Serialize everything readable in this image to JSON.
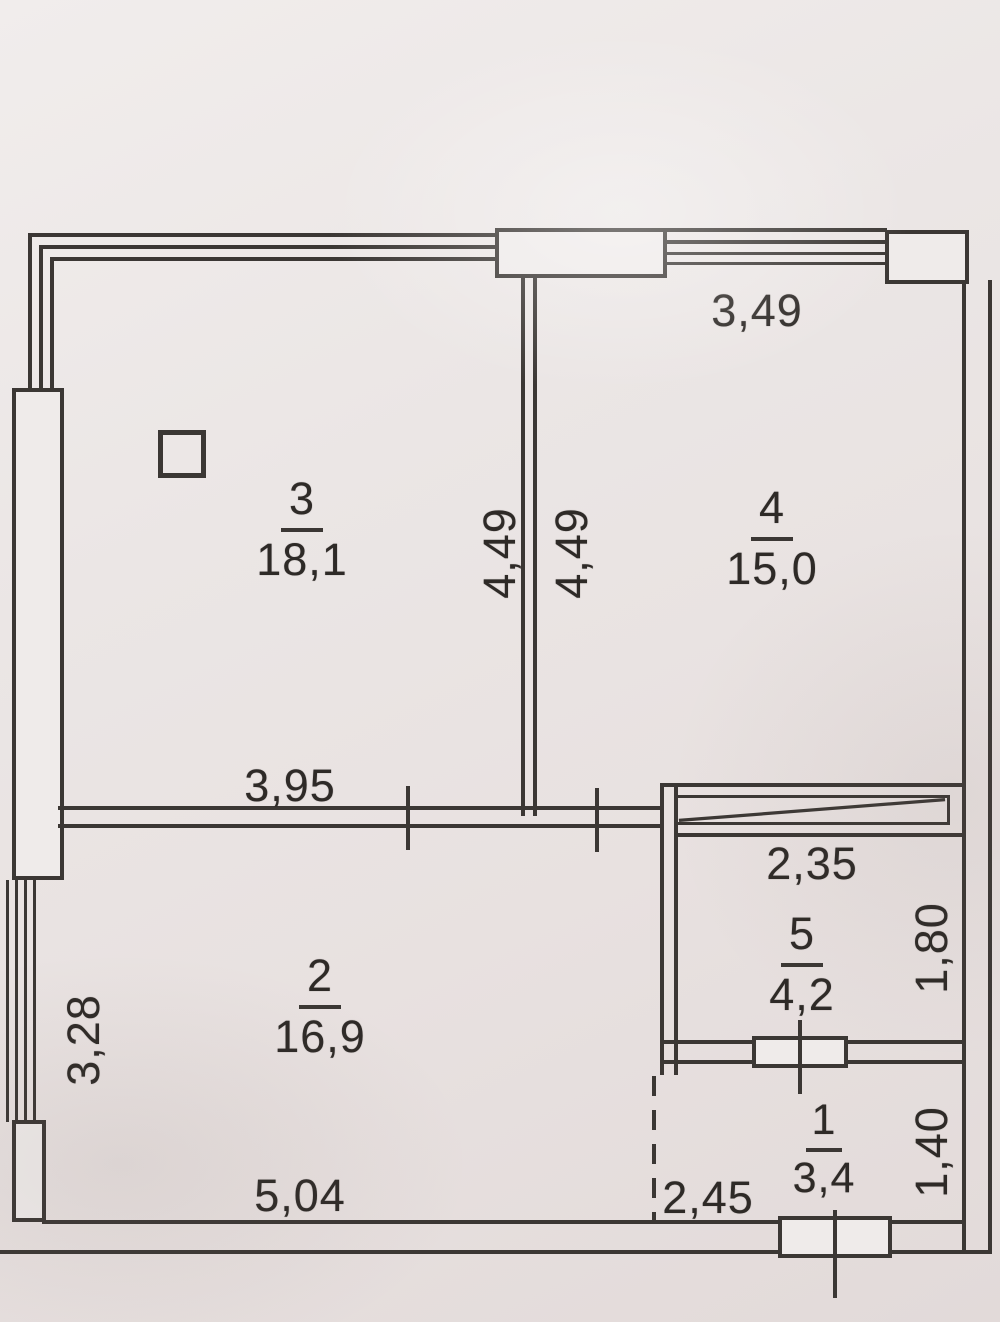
{
  "title": "Apartment floor plan scan",
  "colors": {
    "paper": "#eae5e4",
    "ink": "#3b3734"
  },
  "rooms": [
    {
      "number": "3",
      "area": "18,1"
    },
    {
      "number": "4",
      "area": "15,0"
    },
    {
      "number": "2",
      "area": "16,9"
    },
    {
      "number": "5",
      "area": "4,2"
    },
    {
      "number": "1",
      "area": "3,4"
    }
  ],
  "dimensions": {
    "room4_top_width": "3,49",
    "wall34_height_room3_side": "4,49",
    "wall34_height_room4_side": "4,49",
    "room3_bottom_width": "3,95",
    "room5_width": "2,35",
    "room5_height": "1,80",
    "room2_left_height": "3,28",
    "room2_bottom_width": "5,04",
    "room1_opening_width": "2,45",
    "room1_height": "1,40"
  }
}
